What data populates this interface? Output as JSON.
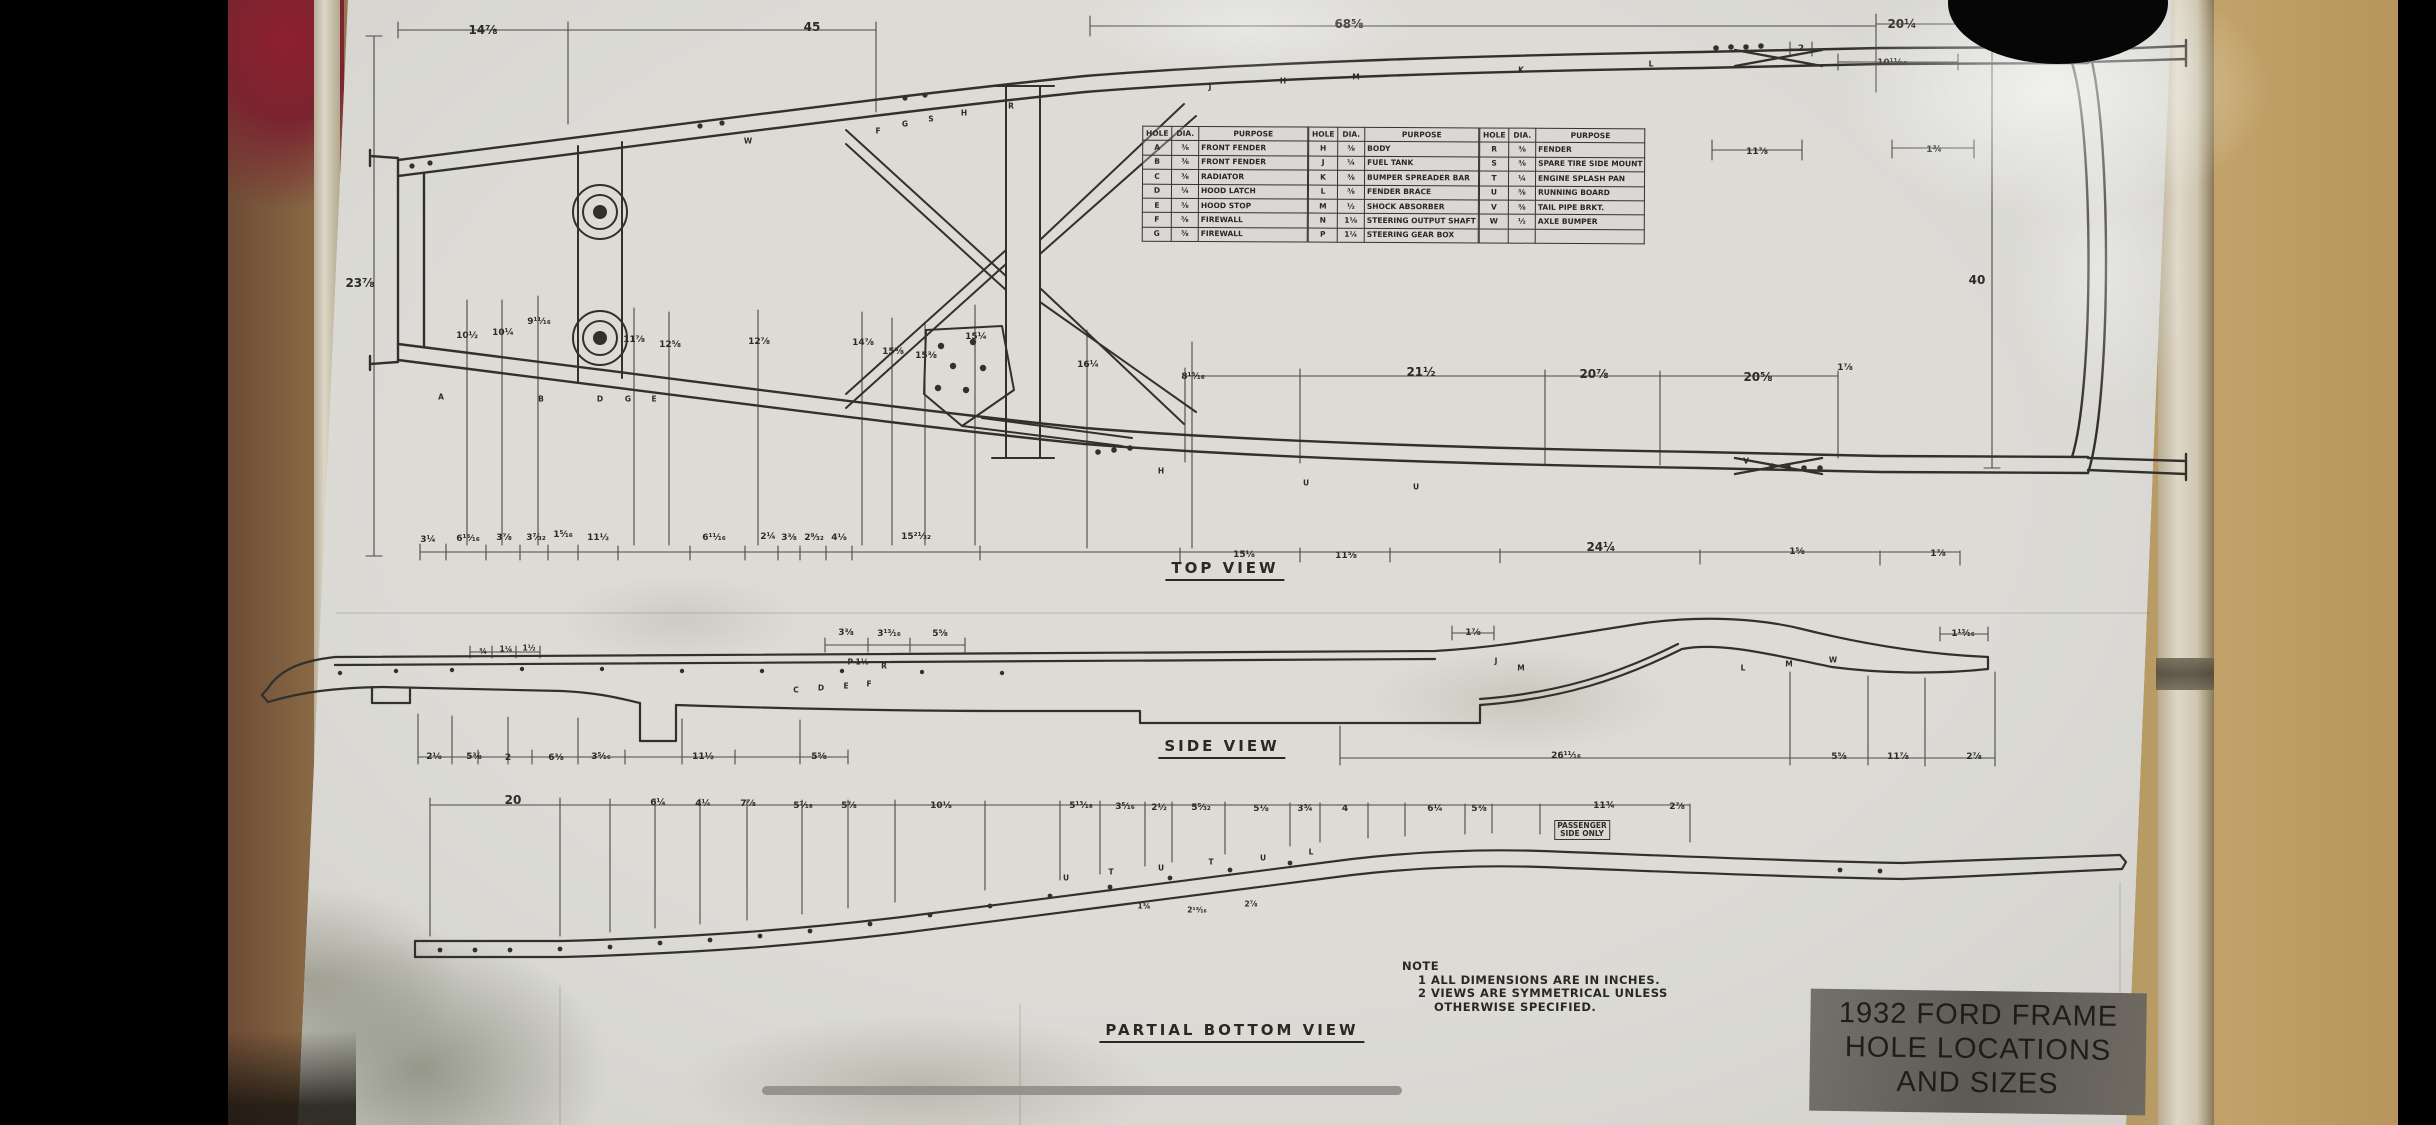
{
  "scene": {
    "description": "Photograph of a laminated hand-drawn engineering blueprint taped to a wall",
    "colors": {
      "paper": "#d6d5d0",
      "ink": "#2e2b27",
      "wall_tan": "#a8905f",
      "red_object": "#8e1f2e",
      "title_label_bg": "#5d5a55",
      "home_indicator": "#8e8d88"
    }
  },
  "views": [
    "TOP VIEW",
    "SIDE VIEW",
    "PARTIAL BOTTOM VIEW"
  ],
  "note": {
    "title": "NOTE",
    "lines": [
      {
        "t": "1  ALL DIMENSIONS ARE IN INCHES.",
        "c": "ind1"
      },
      {
        "t": "2  VIEWS ARE SYMMETRICAL UNLESS",
        "c": "ind1"
      },
      {
        "t": "OTHERWISE SPECIFIED.",
        "c": "ind2"
      }
    ]
  },
  "title_block": {
    "lines": [
      "1932 FORD FRAME",
      "HOLE LOCATIONS",
      "AND SIZES"
    ]
  },
  "table": {
    "headers": [
      "HOLE",
      "DIA.",
      "PURPOSE"
    ],
    "g1": [
      {
        "h": "A",
        "d": "⅜",
        "p": "FRONT FENDER"
      },
      {
        "h": "B",
        "d": "⅜",
        "p": "FRONT FENDER"
      },
      {
        "h": "C",
        "d": "⅜",
        "p": "RADIATOR"
      },
      {
        "h": "D",
        "d": "¼",
        "p": "HOOD LATCH"
      },
      {
        "h": "E",
        "d": "⅜",
        "p": "HOOD STOP"
      },
      {
        "h": "F",
        "d": "⅜",
        "p": "FIREWALL"
      },
      {
        "h": "G",
        "d": "⅜",
        "p": "FIREWALL"
      }
    ],
    "g2": [
      {
        "h": "H",
        "d": "⅜",
        "p": "BODY"
      },
      {
        "h": "J",
        "d": "¼",
        "p": "FUEL TANK"
      },
      {
        "h": "K",
        "d": "⅜",
        "p": "BUMPER SPREADER BAR"
      },
      {
        "h": "L",
        "d": "⅜",
        "p": "FENDER BRACE"
      },
      {
        "h": "M",
        "d": "½",
        "p": "SHOCK ABSORBER"
      },
      {
        "h": "N",
        "d": "1⅛",
        "p": "STEERING OUTPUT SHAFT"
      },
      {
        "h": "P",
        "d": "1¼",
        "p": "STEERING GEAR BOX"
      }
    ],
    "g3": [
      {
        "h": "R",
        "d": "⅜",
        "p": "FENDER"
      },
      {
        "h": "S",
        "d": "⅜",
        "p": "SPARE TIRE SIDE MOUNT"
      },
      {
        "h": "T",
        "d": "¼",
        "p": "ENGINE SPLASH PAN"
      },
      {
        "h": "U",
        "d": "⅜",
        "p": "RUNNING BOARD"
      },
      {
        "h": "V",
        "d": "⅜",
        "p": "TAIL PIPE BRKT."
      },
      {
        "h": "W",
        "d": "½",
        "p": "AXLE BUMPER"
      },
      {
        "h": "",
        "d": "",
        "p": ""
      }
    ]
  },
  "dims": [
    {
      "t": "14⅞",
      "x": 483,
      "y": 30,
      "c": "md"
    },
    {
      "t": "45",
      "x": 812,
      "y": 27,
      "c": "md"
    },
    {
      "t": "68⅝",
      "x": 1349,
      "y": 24,
      "c": "md"
    },
    {
      "t": "20¼",
      "x": 1902,
      "y": 24,
      "c": "md"
    },
    {
      "t": "2",
      "x": 1801,
      "y": 49
    },
    {
      "t": "10¹¹⁄₁₆",
      "x": 1892,
      "y": 63
    },
    {
      "t": "23⅞",
      "x": 360,
      "y": 283,
      "c": "md"
    },
    {
      "t": "40",
      "x": 1977,
      "y": 280,
      "c": "md"
    },
    {
      "t": "11⅞",
      "x": 1757,
      "y": 152
    },
    {
      "t": "1¾",
      "x": 1934,
      "y": 150
    },
    {
      "t": "10½",
      "x": 467,
      "y": 336
    },
    {
      "t": "10¼",
      "x": 503,
      "y": 333
    },
    {
      "t": "9¹¹⁄₁₆",
      "x": 539,
      "y": 322
    },
    {
      "t": "11⅞",
      "x": 634,
      "y": 340
    },
    {
      "t": "12⅝",
      "x": 670,
      "y": 345
    },
    {
      "t": "12⅞",
      "x": 759,
      "y": 342
    },
    {
      "t": "14⅞",
      "x": 863,
      "y": 343
    },
    {
      "t": "15⅝",
      "x": 893,
      "y": 352
    },
    {
      "t": "15⅜",
      "x": 926,
      "y": 356
    },
    {
      "t": "15¼",
      "x": 976,
      "y": 337
    },
    {
      "t": "16¼",
      "x": 1088,
      "y": 365
    },
    {
      "t": "8¹³⁄₁₆",
      "x": 1193,
      "y": 377
    },
    {
      "t": "21½",
      "x": 1421,
      "y": 372,
      "c": "md"
    },
    {
      "t": "20⅞",
      "x": 1594,
      "y": 374,
      "c": "md"
    },
    {
      "t": "20⅝",
      "x": 1758,
      "y": 377,
      "c": "md"
    },
    {
      "t": "1⅞",
      "x": 1845,
      "y": 368
    },
    {
      "t": "3¼",
      "x": 428,
      "y": 540
    },
    {
      "t": "6¹³⁄₁₆",
      "x": 468,
      "y": 539
    },
    {
      "t": "3⅞",
      "x": 504,
      "y": 538
    },
    {
      "t": "3⁷⁄₃₂",
      "x": 536,
      "y": 538
    },
    {
      "t": "1⁵⁄₁₆",
      "x": 563,
      "y": 535
    },
    {
      "t": "11½",
      "x": 598,
      "y": 538
    },
    {
      "t": "6¹¹⁄₁₆",
      "x": 714,
      "y": 538
    },
    {
      "t": "2¼",
      "x": 768,
      "y": 537
    },
    {
      "t": "3⅜",
      "x": 789,
      "y": 538
    },
    {
      "t": "2⁹⁄₃₂",
      "x": 814,
      "y": 538
    },
    {
      "t": "4⅛",
      "x": 839,
      "y": 538
    },
    {
      "t": "15²¹⁄₃₂",
      "x": 916,
      "y": 537
    },
    {
      "t": "15⅛",
      "x": 1244,
      "y": 555
    },
    {
      "t": "11⅝",
      "x": 1346,
      "y": 556
    },
    {
      "t": "24¼",
      "x": 1601,
      "y": 547,
      "c": "md"
    },
    {
      "t": "1⅝",
      "x": 1797,
      "y": 552
    },
    {
      "t": "1⅞",
      "x": 1938,
      "y": 554
    },
    {
      "t": "A",
      "x": 441,
      "y": 397,
      "c": "sm"
    },
    {
      "t": "B",
      "x": 541,
      "y": 399,
      "c": "sm"
    },
    {
      "t": "D",
      "x": 600,
      "y": 399,
      "c": "sm"
    },
    {
      "t": "G",
      "x": 628,
      "y": 399,
      "c": "sm"
    },
    {
      "t": "E",
      "x": 654,
      "y": 399,
      "c": "sm"
    },
    {
      "t": "W",
      "x": 748,
      "y": 141,
      "c": "sm"
    },
    {
      "t": "F",
      "x": 878,
      "y": 131,
      "c": "sm"
    },
    {
      "t": "G",
      "x": 905,
      "y": 124,
      "c": "sm"
    },
    {
      "t": "S",
      "x": 931,
      "y": 119,
      "c": "sm"
    },
    {
      "t": "H",
      "x": 964,
      "y": 113,
      "c": "sm"
    },
    {
      "t": "R",
      "x": 1011,
      "y": 106,
      "c": "sm"
    },
    {
      "t": "J",
      "x": 1210,
      "y": 87,
      "c": "sm"
    },
    {
      "t": "H",
      "x": 1283,
      "y": 81,
      "c": "sm"
    },
    {
      "t": "M",
      "x": 1356,
      "y": 77,
      "c": "sm"
    },
    {
      "t": "K",
      "x": 1521,
      "y": 70,
      "c": "sm"
    },
    {
      "t": "L",
      "x": 1651,
      "y": 64,
      "c": "sm"
    },
    {
      "t": "H",
      "x": 1161,
      "y": 471,
      "c": "sm"
    },
    {
      "t": "U",
      "x": 1306,
      "y": 483,
      "c": "sm"
    },
    {
      "t": "U",
      "x": 1416,
      "y": 487,
      "c": "sm"
    },
    {
      "t": "V",
      "x": 1746,
      "y": 461,
      "c": "sm"
    },
    {
      "t": "3⅜",
      "x": 846,
      "y": 633
    },
    {
      "t": "3¹³⁄₁₆",
      "x": 889,
      "y": 634
    },
    {
      "t": "5⅝",
      "x": 940,
      "y": 634
    },
    {
      "t": "¾",
      "x": 483,
      "y": 651,
      "c": "sm"
    },
    {
      "t": "1¼",
      "x": 506,
      "y": 649,
      "c": "sm"
    },
    {
      "t": "1½",
      "x": 529,
      "y": 648,
      "c": "sm"
    },
    {
      "t": "1⅞",
      "x": 1473,
      "y": 633
    },
    {
      "t": "1¹³⁄₁₆",
      "x": 1963,
      "y": 634
    },
    {
      "t": "P 1⅛",
      "x": 858,
      "y": 662,
      "c": "sm"
    },
    {
      "t": "R",
      "x": 884,
      "y": 666,
      "c": "sm"
    },
    {
      "t": "C",
      "x": 796,
      "y": 690,
      "c": "sm"
    },
    {
      "t": "D",
      "x": 821,
      "y": 688,
      "c": "sm"
    },
    {
      "t": "E",
      "x": 846,
      "y": 686,
      "c": "sm"
    },
    {
      "t": "F",
      "x": 869,
      "y": 684,
      "c": "sm"
    },
    {
      "t": "J",
      "x": 1496,
      "y": 661,
      "c": "sm"
    },
    {
      "t": "M",
      "x": 1521,
      "y": 668,
      "c": "sm"
    },
    {
      "t": "L",
      "x": 1743,
      "y": 668,
      "c": "sm"
    },
    {
      "t": "M",
      "x": 1789,
      "y": 664,
      "c": "sm"
    },
    {
      "t": "W",
      "x": 1833,
      "y": 660,
      "c": "sm"
    },
    {
      "t": "2⅛",
      "x": 434,
      "y": 757
    },
    {
      "t": "5⅜",
      "x": 474,
      "y": 757
    },
    {
      "t": "2",
      "x": 508,
      "y": 758
    },
    {
      "t": "6⅜",
      "x": 556,
      "y": 758
    },
    {
      "t": "3⁵⁄₁₆",
      "x": 601,
      "y": 757
    },
    {
      "t": "11½",
      "x": 703,
      "y": 757
    },
    {
      "t": "5⅝",
      "x": 819,
      "y": 757
    },
    {
      "t": "26¹¹⁄₁₆",
      "x": 1566,
      "y": 756
    },
    {
      "t": "5⅝",
      "x": 1839,
      "y": 757
    },
    {
      "t": "11⅞",
      "x": 1898,
      "y": 757
    },
    {
      "t": "2⅞",
      "x": 1974,
      "y": 757
    },
    {
      "t": "20",
      "x": 513,
      "y": 800,
      "c": "md"
    },
    {
      "t": "6¼",
      "x": 658,
      "y": 803
    },
    {
      "t": "4¼",
      "x": 703,
      "y": 804
    },
    {
      "t": "7⅞",
      "x": 748,
      "y": 804
    },
    {
      "t": "5⁷⁄₁₆",
      "x": 803,
      "y": 806
    },
    {
      "t": "5⅞",
      "x": 849,
      "y": 806
    },
    {
      "t": "10⅛",
      "x": 941,
      "y": 806
    },
    {
      "t": "5¹³⁄₁₆",
      "x": 1081,
      "y": 806
    },
    {
      "t": "3⁵⁄₁₆",
      "x": 1125,
      "y": 807
    },
    {
      "t": "2½",
      "x": 1159,
      "y": 808
    },
    {
      "t": "5⁵⁄₃₂",
      "x": 1201,
      "y": 808
    },
    {
      "t": "5⅛",
      "x": 1261,
      "y": 809
    },
    {
      "t": "3¾",
      "x": 1305,
      "y": 809
    },
    {
      "t": "4",
      "x": 1345,
      "y": 809
    },
    {
      "t": "6¼",
      "x": 1435,
      "y": 809
    },
    {
      "t": "5⅜",
      "x": 1479,
      "y": 809
    },
    {
      "t": "11¾",
      "x": 1604,
      "y": 806
    },
    {
      "t": "2⅞",
      "x": 1677,
      "y": 807
    },
    {
      "t": "PASSENGER\nSIDE ONLY",
      "x": 1582,
      "y": 830,
      "c": "pre"
    },
    {
      "t": "U",
      "x": 1066,
      "y": 878,
      "c": "sm"
    },
    {
      "t": "T",
      "x": 1111,
      "y": 872,
      "c": "sm"
    },
    {
      "t": "U",
      "x": 1161,
      "y": 868,
      "c": "sm"
    },
    {
      "t": "T",
      "x": 1211,
      "y": 862,
      "c": "sm"
    },
    {
      "t": "U",
      "x": 1263,
      "y": 858,
      "c": "sm"
    },
    {
      "t": "L",
      "x": 1311,
      "y": 852,
      "c": "sm"
    },
    {
      "t": "1¾",
      "x": 1144,
      "y": 906,
      "c": "sm"
    },
    {
      "t": "2¹³⁄₁₆",
      "x": 1197,
      "y": 910,
      "c": "sm"
    },
    {
      "t": "2⅞",
      "x": 1251,
      "y": 904,
      "c": "sm"
    }
  ]
}
